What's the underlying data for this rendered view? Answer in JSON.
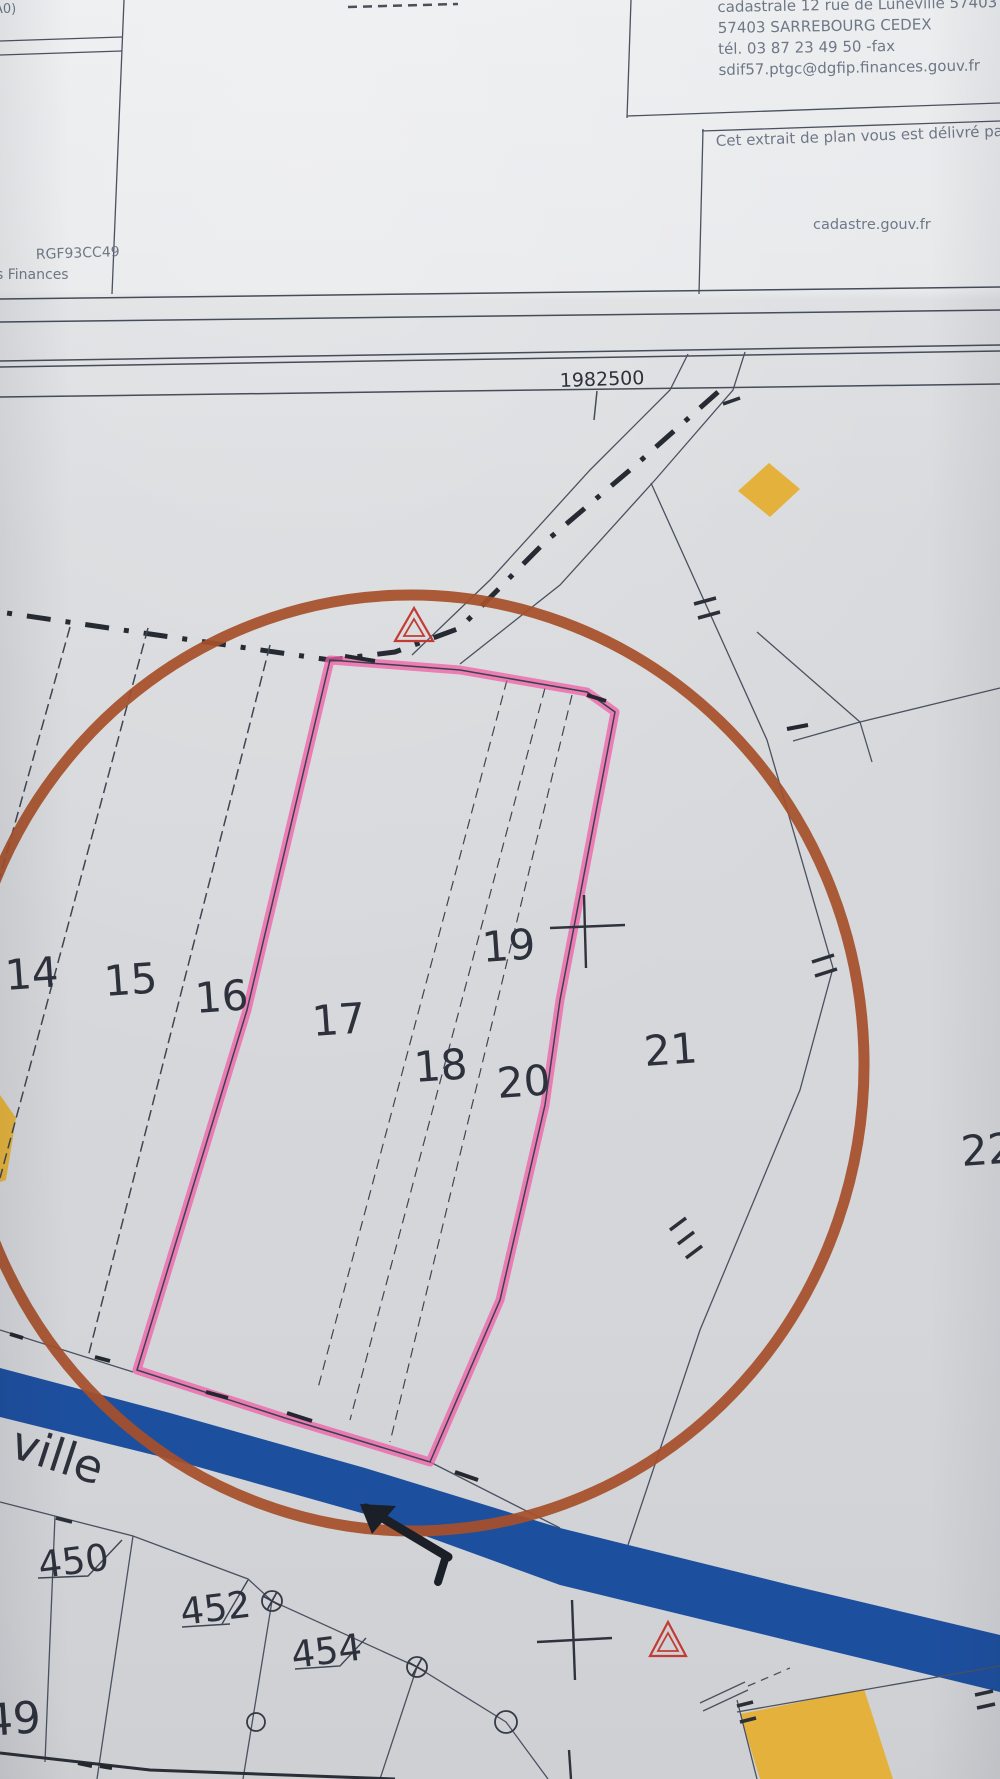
{
  "document": {
    "corner_note": "A0)",
    "office_address_lines": [
      "cadastrale 12 rue de Lunéville 57403",
      "57403 SARREBOURG CEDEX",
      "tél. 03 87 23 49 50 -fax",
      "sdif57.ptgc@dgfip.finances.gouv.fr"
    ],
    "delivery_note": "Cet extrait de plan vous est délivré pa",
    "website": "cadastre.gouv.fr",
    "projection_partial": "RGF93CC49",
    "ministry_partial": "s Finances"
  },
  "map": {
    "grid_coordinate": "1982500",
    "street_name_partial": "ville",
    "parcel_labels": {
      "p14": "14",
      "p15": "15",
      "p16": "16",
      "p17": "17",
      "p18": "18",
      "p19": "19",
      "p20": "20",
      "p21": "21",
      "p22_partial": "22",
      "p450": "450",
      "p452": "452",
      "p454": "454",
      "p49": "49"
    },
    "symbols": {
      "geodetic_triangle": "△",
      "survey_cross": "+",
      "boundary_marker_circle": "○",
      "boundary_marker_circled_cross": "⊕"
    }
  },
  "colors": {
    "highlight_pink": "#f25ea6",
    "annotation_circle_brown": "#a6502a",
    "river_blue": "#1d4f9f",
    "parcel_yellow": "#e4b23c",
    "geodetic_triangle_red": "#c23c34"
  }
}
